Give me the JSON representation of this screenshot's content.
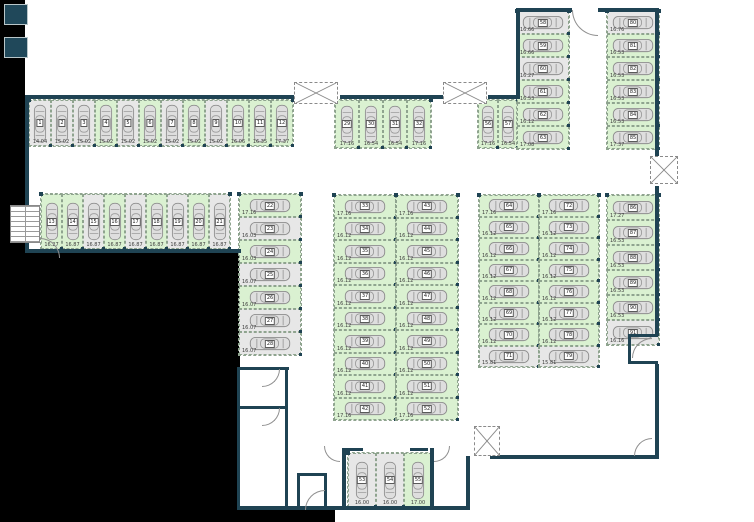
{
  "colors": {
    "wall": "#1f4353",
    "free_space_bg": "#daf1d1",
    "occupied_space_bg": "#e7e7e7",
    "outside": "#000000",
    "floor": "#ffffff",
    "car_body": "#dedede",
    "car_outline": "#8e8e8e",
    "dashed_line": "#8fa48f"
  },
  "plan": {
    "zones": [
      {
        "id": "z-row-1-12",
        "orientation": "v",
        "spaces": [
          {
            "n": "1",
            "dim": "14.04",
            "free": false
          },
          {
            "n": "2",
            "dim": "15.02",
            "free": false
          },
          {
            "n": "3",
            "dim": "15.02",
            "free": false
          },
          {
            "n": "4",
            "dim": "15.02",
            "free": true
          },
          {
            "n": "5",
            "dim": "15.02",
            "free": false
          },
          {
            "n": "6",
            "dim": "15.02",
            "free": true
          },
          {
            "n": "7",
            "dim": "15.02",
            "free": false
          },
          {
            "n": "8",
            "dim": "15.02",
            "free": true
          },
          {
            "n": "9",
            "dim": "15.02",
            "free": false
          },
          {
            "n": "10",
            "dim": "16.06",
            "free": true
          },
          {
            "n": "11",
            "dim": "16.35",
            "free": true
          },
          {
            "n": "12",
            "dim": "17.37",
            "free": true
          }
        ]
      },
      {
        "id": "z-row-13-21",
        "orientation": "v",
        "spaces": [
          {
            "n": "13",
            "dim": "16.27",
            "free": true
          },
          {
            "n": "14",
            "dim": "16.87",
            "free": true
          },
          {
            "n": "15",
            "dim": "16.87",
            "free": false
          },
          {
            "n": "16",
            "dim": "16.87",
            "free": true
          },
          {
            "n": "17",
            "dim": "16.87",
            "free": false
          },
          {
            "n": "18",
            "dim": "16.87",
            "free": true
          },
          {
            "n": "19",
            "dim": "16.87",
            "free": false
          },
          {
            "n": "20",
            "dim": "16.87",
            "free": true
          },
          {
            "n": "21",
            "dim": "16.87",
            "free": false
          }
        ]
      },
      {
        "id": "z-col-22-28",
        "orientation": "h",
        "spaces": [
          {
            "n": "22",
            "dim": "17.16",
            "free": true
          },
          {
            "n": "23",
            "dim": "16.03",
            "free": false
          },
          {
            "n": "24",
            "dim": "16.03",
            "free": true
          },
          {
            "n": "25",
            "dim": "16.07",
            "free": false
          },
          {
            "n": "26",
            "dim": "16.07",
            "free": true
          },
          {
            "n": "27",
            "dim": "16.07",
            "free": false
          },
          {
            "n": "28",
            "dim": "16.07",
            "free": false
          }
        ]
      },
      {
        "id": "z-row-29-32",
        "orientation": "v",
        "spaces": [
          {
            "n": "29",
            "dim": "17.16",
            "free": true
          },
          {
            "n": "30",
            "dim": "16.54",
            "free": true
          },
          {
            "n": "31",
            "dim": "16.54",
            "free": true
          },
          {
            "n": "32",
            "dim": "17.16",
            "free": true
          }
        ]
      },
      {
        "id": "z-col-33-42",
        "orientation": "h",
        "spaces": [
          {
            "n": "33",
            "dim": "17.16",
            "free": true
          },
          {
            "n": "34",
            "dim": "16.12",
            "free": true
          },
          {
            "n": "35",
            "dim": "16.12",
            "free": true
          },
          {
            "n": "36",
            "dim": "16.12",
            "free": true
          },
          {
            "n": "37",
            "dim": "16.12",
            "free": true
          },
          {
            "n": "38",
            "dim": "16.12",
            "free": true
          },
          {
            "n": "39",
            "dim": "16.12",
            "free": true
          },
          {
            "n": "40",
            "dim": "16.12",
            "free": true
          },
          {
            "n": "41",
            "dim": "16.12",
            "free": true
          },
          {
            "n": "42",
            "dim": "17.16",
            "free": true
          }
        ]
      },
      {
        "id": "z-col-43-52",
        "orientation": "h",
        "spaces": [
          {
            "n": "43",
            "dim": "17.16",
            "free": true
          },
          {
            "n": "44",
            "dim": "16.12",
            "free": true
          },
          {
            "n": "45",
            "dim": "16.12",
            "free": true
          },
          {
            "n": "46",
            "dim": "16.12",
            "free": true
          },
          {
            "n": "47",
            "dim": "16.12",
            "free": true
          },
          {
            "n": "48",
            "dim": "16.12",
            "free": true
          },
          {
            "n": "49",
            "dim": "16.12",
            "free": true
          },
          {
            "n": "50",
            "dim": "16.12",
            "free": true
          },
          {
            "n": "51",
            "dim": "16.12",
            "free": true
          },
          {
            "n": "52",
            "dim": "17.16",
            "free": true
          }
        ]
      },
      {
        "id": "z-room-53-55",
        "orientation": "v",
        "spaces": [
          {
            "n": "53",
            "dim": "16.00",
            "free": false
          },
          {
            "n": "54",
            "dim": "16.00",
            "free": false
          },
          {
            "n": "55",
            "dim": "17.00",
            "free": true
          }
        ]
      },
      {
        "id": "z-row-56-57",
        "orientation": "v",
        "spaces": [
          {
            "n": "56",
            "dim": "17.16",
            "free": true
          },
          {
            "n": "57",
            "dim": "16.54",
            "free": true
          }
        ]
      },
      {
        "id": "z-col-58-63",
        "orientation": "h",
        "spaces": [
          {
            "n": "58",
            "dim": "16.66",
            "free": false
          },
          {
            "n": "59",
            "dim": "16.66",
            "free": true
          },
          {
            "n": "60",
            "dim": "16.27",
            "free": false
          },
          {
            "n": "61",
            "dim": "16.53",
            "free": true
          },
          {
            "n": "62",
            "dim": "16.12",
            "free": true
          },
          {
            "n": "63",
            "dim": "17.08",
            "free": true
          }
        ]
      },
      {
        "id": "z-col-64-71",
        "orientation": "h",
        "spaces": [
          {
            "n": "64",
            "dim": "17.16",
            "free": true
          },
          {
            "n": "65",
            "dim": "16.12",
            "free": true
          },
          {
            "n": "66",
            "dim": "16.12",
            "free": true
          },
          {
            "n": "67",
            "dim": "16.12",
            "free": true
          },
          {
            "n": "68",
            "dim": "16.12",
            "free": true
          },
          {
            "n": "69",
            "dim": "16.12",
            "free": true
          },
          {
            "n": "70",
            "dim": "16.12",
            "free": true
          },
          {
            "n": "71",
            "dim": "15.81",
            "free": false
          }
        ]
      },
      {
        "id": "z-col-72-79",
        "orientation": "h",
        "spaces": [
          {
            "n": "72",
            "dim": "17.16",
            "free": true
          },
          {
            "n": "73",
            "dim": "16.12",
            "free": true
          },
          {
            "n": "74",
            "dim": "16.12",
            "free": true
          },
          {
            "n": "75",
            "dim": "16.12",
            "free": true
          },
          {
            "n": "76",
            "dim": "16.12",
            "free": true
          },
          {
            "n": "77",
            "dim": "16.12",
            "free": true
          },
          {
            "n": "78",
            "dim": "16.12",
            "free": true
          },
          {
            "n": "79",
            "dim": "15.81",
            "free": false
          }
        ]
      },
      {
        "id": "z-col-80-85",
        "orientation": "h",
        "spaces": [
          {
            "n": "80",
            "dim": "16.76",
            "free": false
          },
          {
            "n": "81",
            "dim": "16.53",
            "free": true
          },
          {
            "n": "82",
            "dim": "16.53",
            "free": true
          },
          {
            "n": "83",
            "dim": "16.53",
            "free": true
          },
          {
            "n": "84",
            "dim": "16.53",
            "free": true
          },
          {
            "n": "85",
            "dim": "17.37",
            "free": true
          }
        ]
      },
      {
        "id": "z-col-86-91",
        "orientation": "h",
        "spaces": [
          {
            "n": "86",
            "dim": "17.27",
            "free": true
          },
          {
            "n": "87",
            "dim": "16.53",
            "free": true
          },
          {
            "n": "88",
            "dim": "16.53",
            "free": true
          },
          {
            "n": "89",
            "dim": "16.53",
            "free": true
          },
          {
            "n": "90",
            "dim": "16.53",
            "free": true
          },
          {
            "n": "91",
            "dim": "16.16",
            "free": false
          }
        ]
      }
    ]
  }
}
